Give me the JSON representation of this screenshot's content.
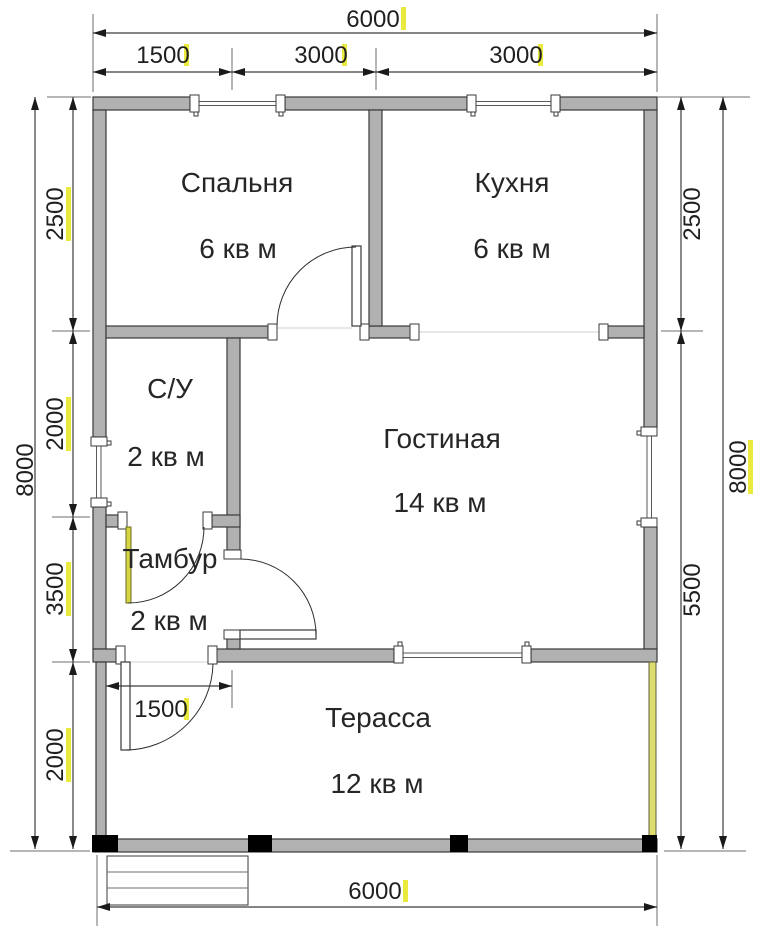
{
  "plan": {
    "rooms": [
      {
        "name": "Спальня",
        "area": "6 кв м"
      },
      {
        "name": "Кухня",
        "area": "6 кв м"
      },
      {
        "name": "С/У",
        "area": "2 кв м"
      },
      {
        "name": "Гостиная",
        "area": "14 кв м"
      },
      {
        "name": "Тамбур",
        "area": "2 кв м"
      },
      {
        "name": "Терасса",
        "area": "12 кв м"
      }
    ],
    "dimensions_mm": {
      "top": {
        "overall": "6000",
        "segments": [
          "1500",
          "3000",
          "3000"
        ]
      },
      "bottom": {
        "overall": "6000"
      },
      "left": {
        "overall": "8000",
        "segments": [
          "2500",
          "2000",
          "3500",
          "2000"
        ]
      },
      "right": {
        "overall": "8000",
        "segments": [
          "2500",
          "5500"
        ]
      },
      "interior": {
        "terrace_door_offset": "1500"
      }
    },
    "colors": {
      "wall_fill": "#b1b1b1",
      "outline": "#3a3a3a",
      "highlight_yellow": "#e9e93f",
      "terrace_edge": "#dedc6e",
      "post_black": "#000000"
    }
  }
}
